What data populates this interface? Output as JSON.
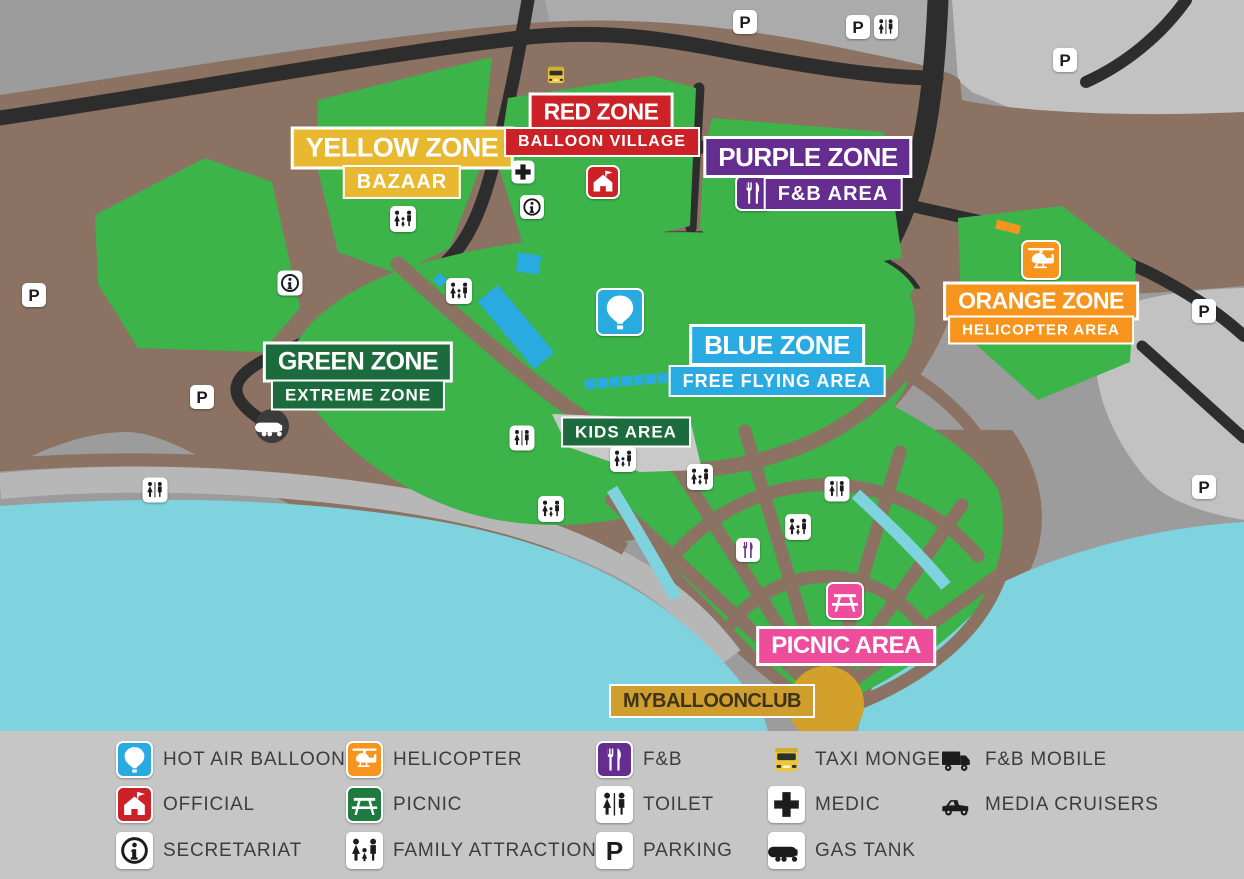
{
  "palette": {
    "background_gray": "#9c9c9c",
    "parking_lot_gray": "#c2c2c2",
    "land_brown": "#8b7263",
    "road_black": "#2d2d2d",
    "park_green": "#3cb44a",
    "water_cyan": "#7ed3de",
    "zone_yellow": "#e9b831",
    "zone_red": "#cd2128",
    "zone_purple": "#662d91",
    "zone_orange": "#f7941e",
    "zone_dark_green": "#1b6b3d",
    "zone_blue": "#29abe2",
    "zone_pink": "#ee4d9c",
    "club_gold": "#cf9e2e",
    "hub_gold": "#d4a02c",
    "legend_gray": "#c6c6c6"
  },
  "map": {
    "zones": [
      {
        "id": "yellow",
        "title": "YELLOW ZONE",
        "subtitle": "BAZAAR"
      },
      {
        "id": "red",
        "title": "RED ZONE",
        "subtitle": "BALLOON VILLAGE"
      },
      {
        "id": "purple",
        "title": "PURPLE ZONE",
        "subtitle": "F&B AREA"
      },
      {
        "id": "orange",
        "title": "ORANGE ZONE",
        "subtitle": "HELICOPTER AREA"
      },
      {
        "id": "green",
        "title": "GREEN ZONE",
        "subtitle": "EXTREME ZONE"
      },
      {
        "id": "blue",
        "title": "BLUE ZONE",
        "subtitle": "FREE FLYING AREA"
      },
      {
        "id": "kids",
        "title": "KIDS AREA"
      },
      {
        "id": "picnic",
        "title": "PICNIC AREA"
      },
      {
        "id": "club",
        "title": "MYBALLOONCLUB"
      }
    ],
    "icons": [
      {
        "type": "taxi-monger",
        "x": 556,
        "y": 75,
        "size": 26
      },
      {
        "type": "parking",
        "x": 745,
        "y": 22,
        "size": 24
      },
      {
        "type": "parking",
        "x": 858,
        "y": 27,
        "size": 24
      },
      {
        "type": "toilet",
        "x": 886,
        "y": 27,
        "size": 24
      },
      {
        "type": "parking",
        "x": 1065,
        "y": 60,
        "size": 24
      },
      {
        "type": "parking",
        "x": 1204,
        "y": 311,
        "size": 24
      },
      {
        "type": "parking",
        "x": 1204,
        "y": 487,
        "size": 24
      },
      {
        "type": "parking",
        "x": 34,
        "y": 295,
        "size": 24
      },
      {
        "type": "parking",
        "x": 202,
        "y": 397,
        "size": 24
      },
      {
        "type": "medic",
        "x": 523,
        "y": 172,
        "size": 23
      },
      {
        "type": "secretariat",
        "x": 532,
        "y": 207,
        "size": 24
      },
      {
        "type": "official",
        "x": 603,
        "y": 182,
        "size": 34
      },
      {
        "type": "secretariat",
        "x": 290,
        "y": 283,
        "size": 25
      },
      {
        "type": "gas-tank-map",
        "x": 272,
        "y": 426,
        "size": 34
      },
      {
        "type": "family",
        "x": 403,
        "y": 219,
        "size": 26
      },
      {
        "type": "family",
        "x": 459,
        "y": 291,
        "size": 26
      },
      {
        "type": "toilet",
        "x": 522,
        "y": 438,
        "size": 25
      },
      {
        "type": "family",
        "x": 623,
        "y": 459,
        "size": 26
      },
      {
        "type": "family",
        "x": 700,
        "y": 477,
        "size": 26
      },
      {
        "type": "family",
        "x": 551,
        "y": 509,
        "size": 26
      },
      {
        "type": "toilet",
        "x": 155,
        "y": 490,
        "size": 25
      },
      {
        "type": "toilet",
        "x": 837,
        "y": 489,
        "size": 25
      },
      {
        "type": "family",
        "x": 798,
        "y": 527,
        "size": 26
      },
      {
        "type": "fnb-small",
        "x": 748,
        "y": 550,
        "size": 24
      },
      {
        "type": "fnb-zone",
        "x": 753,
        "y": 193,
        "size": 36
      },
      {
        "type": "helicopter-zone",
        "x": 1041,
        "y": 260,
        "size": 40
      },
      {
        "type": "balloon-zone",
        "x": 620,
        "y": 312,
        "size": 48
      },
      {
        "type": "picnic-zone",
        "x": 845,
        "y": 601,
        "size": 38
      }
    ],
    "pads": [
      {
        "x": 516,
        "y": 327,
        "w": 88,
        "h": 26,
        "r": 50,
        "c": "#29abe2"
      },
      {
        "x": 528,
        "y": 263,
        "w": 23,
        "h": 19,
        "r": 8,
        "c": "#29abe2"
      },
      {
        "x": 440,
        "y": 280,
        "w": 10,
        "h": 10,
        "r": 45,
        "c": "#29abe2"
      },
      {
        "x": 590,
        "y": 384,
        "w": 11,
        "h": 10,
        "r": -4,
        "c": "#29abe2"
      },
      {
        "x": 602,
        "y": 383,
        "w": 11,
        "h": 10,
        "r": -4,
        "c": "#29abe2"
      },
      {
        "x": 614,
        "y": 382,
        "w": 11,
        "h": 10,
        "r": -4,
        "c": "#29abe2"
      },
      {
        "x": 626,
        "y": 381,
        "w": 11,
        "h": 10,
        "r": -4,
        "c": "#29abe2"
      },
      {
        "x": 638,
        "y": 380,
        "w": 11,
        "h": 10,
        "r": -4,
        "c": "#29abe2"
      },
      {
        "x": 650,
        "y": 379,
        "w": 11,
        "h": 10,
        "r": -4,
        "c": "#29abe2"
      },
      {
        "x": 662,
        "y": 378,
        "w": 11,
        "h": 10,
        "r": -4,
        "c": "#29abe2"
      },
      {
        "x": 1002,
        "y": 225,
        "w": 12,
        "h": 9,
        "r": 14,
        "c": "#f7941e"
      },
      {
        "x": 1014,
        "y": 228,
        "w": 12,
        "h": 9,
        "r": 14,
        "c": "#f7941e"
      }
    ]
  },
  "legend": {
    "columns": [
      {
        "x": 116,
        "items": [
          {
            "type": "hot-air-balloon",
            "label": "HOT AIR BALLOON"
          },
          {
            "type": "official",
            "label": "OFFICIAL"
          },
          {
            "type": "secretariat",
            "label": "SECRETARIAT"
          }
        ]
      },
      {
        "x": 346,
        "items": [
          {
            "type": "helicopter",
            "label": "HELICOPTER"
          },
          {
            "type": "picnic",
            "label": "PICNIC"
          },
          {
            "type": "family",
            "label": "FAMILY ATTRACTION"
          }
        ]
      },
      {
        "x": 596,
        "items": [
          {
            "type": "fnb",
            "label": "F&B"
          },
          {
            "type": "toilet",
            "label": "TOILET"
          },
          {
            "type": "parking",
            "label": "PARKING"
          }
        ]
      },
      {
        "x": 768,
        "items": [
          {
            "type": "taxi-monger",
            "label": "TAXI MONGER"
          },
          {
            "type": "medic",
            "label": "MEDIC"
          },
          {
            "type": "gas-tank",
            "label": "GAS TANK"
          }
        ]
      },
      {
        "x": 938,
        "items": [
          {
            "type": "fnb-mobile",
            "label": "F&B MOBILE"
          },
          {
            "type": "media-cruisers",
            "label": "MEDIA CRUISERS"
          }
        ]
      }
    ]
  }
}
